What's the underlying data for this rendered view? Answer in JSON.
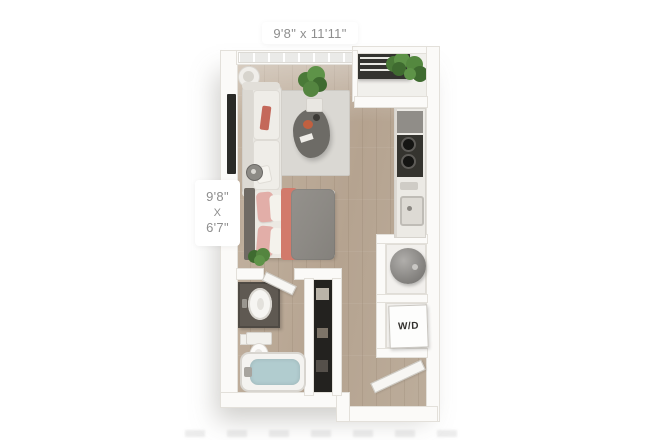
{
  "page": {
    "background": "#ffffff"
  },
  "labels": {
    "living_area_dimensions": "9'8\" x 11'11\"",
    "sleeping_area": {
      "width": "9'8\"",
      "separator": "X",
      "depth": "6'7\""
    },
    "washer_dryer": "W/D"
  },
  "colors": {
    "wall": "#fbfaf8",
    "wall_edge": "#e3e0da",
    "floor_wood": "#b9a795",
    "rug": "#dad8d3",
    "sofa": "#e8e6e1",
    "coffee_table": "#6d6b66",
    "bed_duvet": "#8d8a85",
    "bed_blanket_accent": "#d27a6b",
    "bed_pillow_pink": "#e2aea8",
    "tub_water": "#b1cccf",
    "vanity": "#5f5952",
    "plant_green": "#4a7a38",
    "cooktop": "#35342f",
    "balcony_railing": "#33332f",
    "dimension_text": "#8e8e8e",
    "closet_interior": "#23221f"
  },
  "rooms": {
    "living_room": [
      "sofa",
      "rug",
      "coffee-table",
      "tv",
      "floor-lamp",
      "side-table-lamp",
      "potted-plant"
    ],
    "sleeping_area": [
      "bed",
      "headboard",
      "pillows",
      "throw-blanket",
      "plant"
    ],
    "kitchen": [
      "refrigerator",
      "cooktop",
      "kitchen-sink",
      "counter"
    ],
    "bathroom": [
      "vanity-sink",
      "toilet",
      "bathtub",
      "door"
    ],
    "closet": [
      "wardrobe"
    ],
    "utility": [
      "water-heater",
      "washer-dryer"
    ],
    "balcony": [
      "railing",
      "plants"
    ],
    "entry": [
      "door"
    ]
  }
}
